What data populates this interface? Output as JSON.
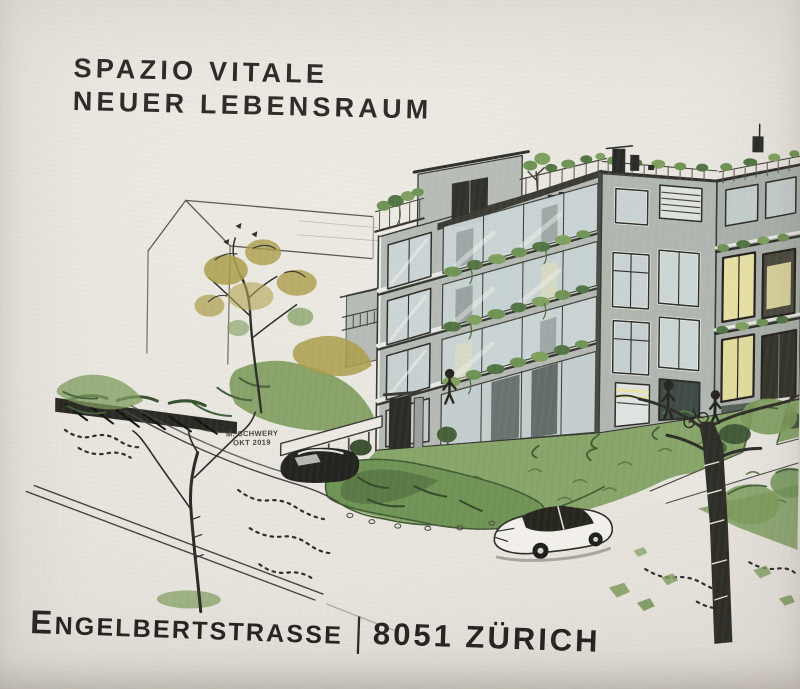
{
  "header": {
    "title_line1": "SPAZIO VITALE",
    "title_line2": "NEUER LEBENSRAUM"
  },
  "footer": {
    "street_initial": "E",
    "street_rest": "NGELBERTSTRASSE",
    "separator": "|",
    "city": "8051 ZÜRICH"
  },
  "illustration": {
    "signature_line1": "M. SCHWERY",
    "signature_line2": "OKT 2019",
    "description": "Hand-drawn architectural rendering of a modern multi-storey apartment building with roof terrace, glazed plant-covered balconies, garden, lawn, street with two cars, foreground trees and a neighbouring gable-roof house outline",
    "palette": {
      "paper": "#e8e4de",
      "ink": "#2c2b28",
      "sketch_line": "#3b3a34",
      "building_gray": "#b5bab5",
      "building_gray_dark": "#aab0ab",
      "glass": "#ccd6d6",
      "warm_window": "#e8e1a5",
      "foliage_green": "#6f9355",
      "grass_green": "#87a569",
      "olive_green": "#ab9c49",
      "dark_green": "#3f5a33",
      "car_dark": "#232320"
    }
  }
}
